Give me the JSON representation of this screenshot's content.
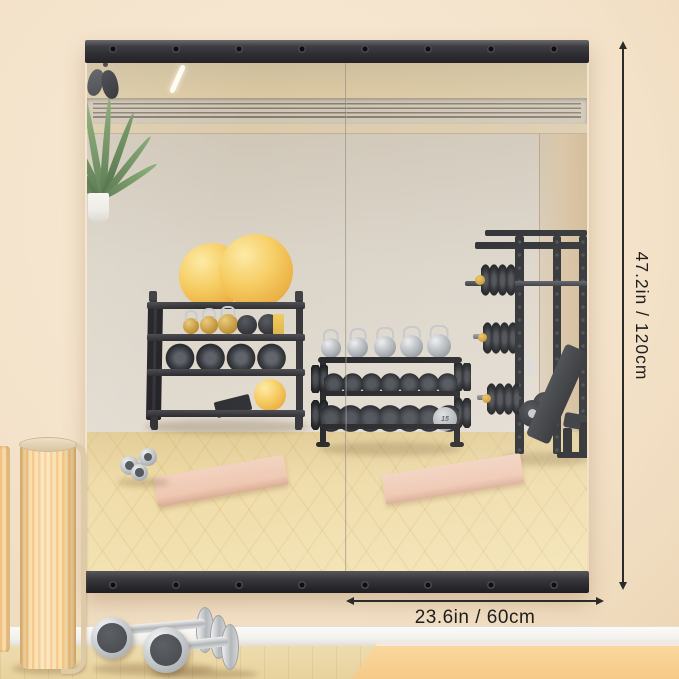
{
  "annotations": {
    "height_label": "47.2in / 120cm",
    "width_label": "23.6in / 60cm"
  },
  "reflection": {
    "dumbbell_plate_label": "15"
  },
  "colors": {
    "wall": "#f4e3cb",
    "mirror_rail": "#3a3a3d",
    "reflection_wall": "#dcd5ca",
    "reflection_ceiling": "#d9c7a1",
    "wood_floor": "#ecd9a8",
    "yoga_mat": "#f0cbb6",
    "exercise_ball_yellow": "#f2c557",
    "foreground_mat": "#f8cf92",
    "baseboard": "#f7f6f3",
    "dimension_line": "#2b2b2b"
  }
}
